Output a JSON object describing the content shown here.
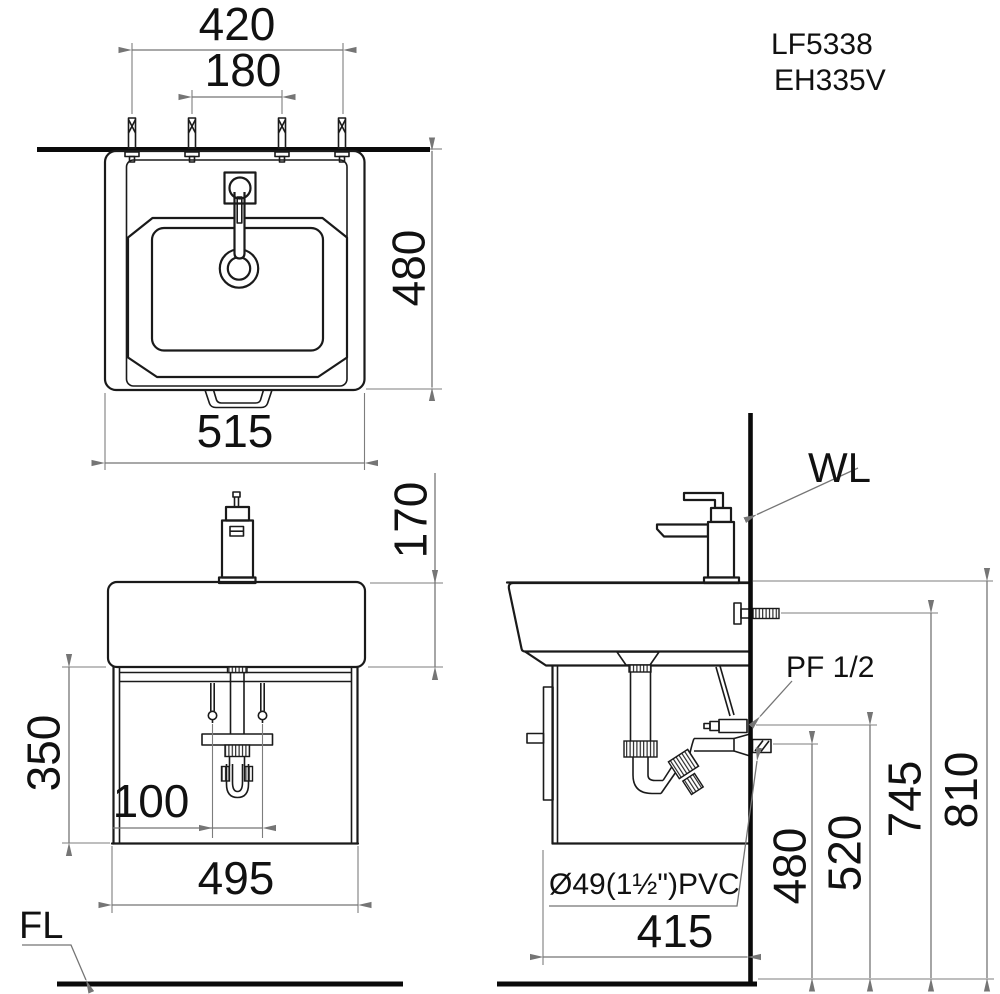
{
  "page": {
    "background": "#ffffff",
    "line_color": "#1a1a1a",
    "dim_color": "#757575"
  },
  "model": {
    "code1": "LF5338",
    "code2": "EH335V"
  },
  "annotations": {
    "wall_line": "WL",
    "floor_line": "FL",
    "supply_fitting": "PF 1/2",
    "drain_pipe_spec": "Ø49(1½\")PVC"
  },
  "dimensions": {
    "plan": {
      "mount_bolt_spacing": "420",
      "faucet_hole_spacing": "180",
      "overall_depth": "480",
      "overall_width": "515"
    },
    "front": {
      "basin_height": "170",
      "cabinet_height": "350",
      "hose_spacing": "100",
      "cabinet_width": "495"
    },
    "side": {
      "cabinet_depth": "415",
      "drain_outlet_height": "480",
      "supply_outlet_height": "520",
      "anchor_bolt_height": "745",
      "rim_height": "810"
    }
  }
}
